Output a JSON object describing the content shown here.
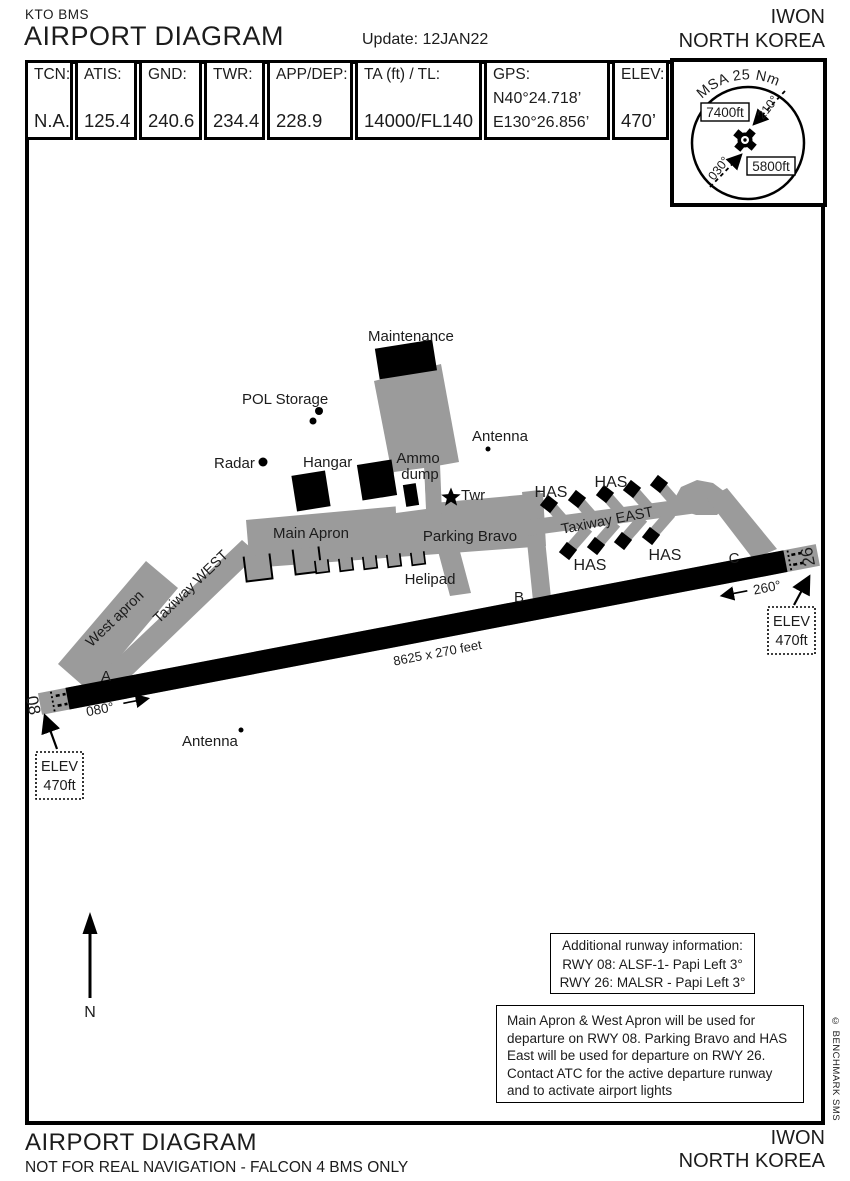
{
  "header": {
    "doc_code": "KTO BMS",
    "title": "AIRPORT DIAGRAM",
    "update": "Update: 12JAN22",
    "airport": "IWON",
    "country": "NORTH KOREA"
  },
  "info_table": {
    "cells": [
      {
        "label": "TCN:",
        "value": "N.A."
      },
      {
        "label": "ATIS:",
        "value": "125.4"
      },
      {
        "label": "GND:",
        "value": "240.6"
      },
      {
        "label": "TWR:",
        "value": "234.4"
      },
      {
        "label": "APP/DEP:",
        "value": "228.9"
      },
      {
        "label": "TA (ft) / TL:",
        "value": "14000/FL140"
      },
      {
        "label": "GPS:",
        "value": "N40°24.718’",
        "value2": "E130°26.856’"
      },
      {
        "label": "ELEV:",
        "value": "470’"
      }
    ]
  },
  "msa": {
    "title": "MSA 25 Nm",
    "alt_nw": "7400ft",
    "alt_se": "5800ft",
    "bearing_sw": "030°",
    "bearing_ne": "210°"
  },
  "diagram": {
    "runway": {
      "id_west": "08",
      "id_east": "26",
      "heading_west": "080°",
      "heading_east": "260°",
      "dimensions": "8625 x 270 feet"
    },
    "labels": {
      "maintenance": "Maintenance",
      "pol_storage": "POL Storage",
      "radar": "Radar",
      "hangar": "Hangar",
      "ammo_line1": "Ammo",
      "ammo_line2": "dump",
      "antenna_north": "Antenna",
      "antenna_south": "Antenna",
      "twr": "Twr",
      "main_apron": "Main Apron",
      "west_apron": "West apron",
      "taxiway_west": "Taxiway WEST",
      "taxiway_east": "Taxiway EAST",
      "parking_bravo": "Parking Bravo",
      "helipad": "Helipad",
      "has": "HAS",
      "taxiway_a": "A",
      "taxiway_b": "B",
      "taxiway_c": "C",
      "north": "N"
    },
    "elev_box": {
      "line1": "ELEV",
      "line2": "470ft"
    }
  },
  "notes": {
    "runway_info": [
      "Additional runway information:",
      "RWY 08: ALSF-1- Papi Left 3°",
      "RWY 26: MALSR - Papi Left 3°"
    ],
    "departure_info": [
      "Main Apron & West Apron will be used for",
      "departure on RWY 08. Parking Bravo and HAS",
      "East will be used for departure on RWY 26.",
      "Contact ATC for the active departure runway",
      "and to activate airport lights"
    ]
  },
  "footer": {
    "title": "AIRPORT DIAGRAM",
    "disclaimer": "NOT FOR REAL NAVIGATION - FALCON 4 BMS ONLY",
    "airport": "IWON",
    "country": "NORTH KOREA"
  },
  "copyright": "© BENCHMARK SMS"
}
